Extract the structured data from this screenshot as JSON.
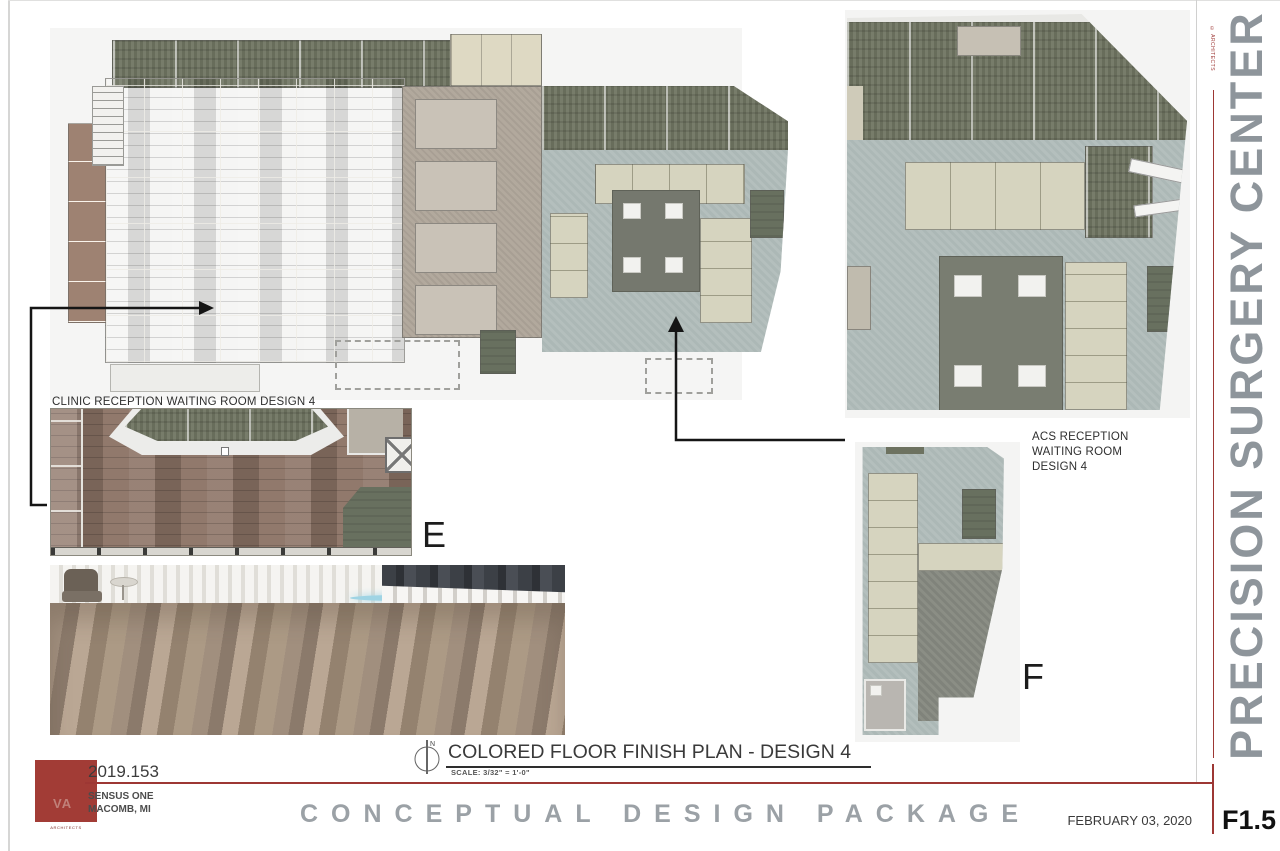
{
  "sheet": {
    "side_title": "PRECISION SURGERY CENTER",
    "copyright_note": "© ARCHITECTS",
    "project_number": "2019.153",
    "project_name": "SENSUS ONE",
    "project_location": "MACOMB, MI",
    "package_title": "CONCEPTUAL DESIGN PACKAGE",
    "date": "FEBRUARY 03, 2020",
    "sheet_number": "F1.5",
    "logo_text": "VA",
    "logo_tagline": "ARCHITECTS"
  },
  "drawing": {
    "title": "COLORED FLOOR FINISH PLAN - DESIGN 4",
    "scale_note": "SCALE: 3/32\" = 1'-0\"",
    "north_label": "N"
  },
  "callouts": {
    "clinic_label": "CLINIC RECEPTION WAITING ROOM DESIGN 4",
    "acs_label": [
      "ACS RECEPTION",
      "WAITING ROOM",
      "DESIGN 4"
    ],
    "detail_e_tag": "E",
    "detail_f_tag": "F"
  },
  "colors": {
    "accent_red": "#9d3734",
    "logo_red": "#a23c36",
    "package_title_gray": "#9ba1a6",
    "side_title_gray": "#8e959b",
    "wood_brown": "#8d7466",
    "olive_green": "#6f7461",
    "blue_gray": "#b4bfbd",
    "seating_cream": "#d6d4bf",
    "or_gray": "#b2a99d",
    "core_dark_gray": "#797d71"
  }
}
